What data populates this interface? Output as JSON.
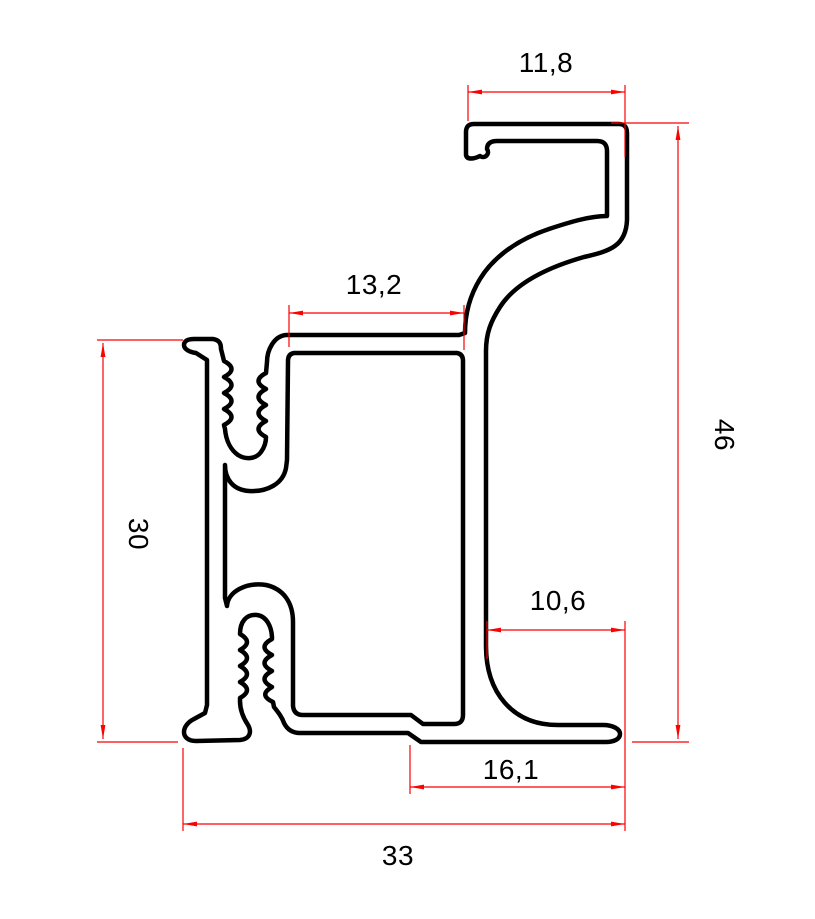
{
  "dims": {
    "hook_width": "11,8",
    "web_width": "13,2",
    "overall_height": "46",
    "left_height": "30",
    "bottom_inner_width": "10,6",
    "bottom_flange_width": "16,1",
    "overall_width": "33"
  },
  "colors": {
    "outline": "#000000",
    "dimension": "#fb0101",
    "background": "#ffffff"
  }
}
